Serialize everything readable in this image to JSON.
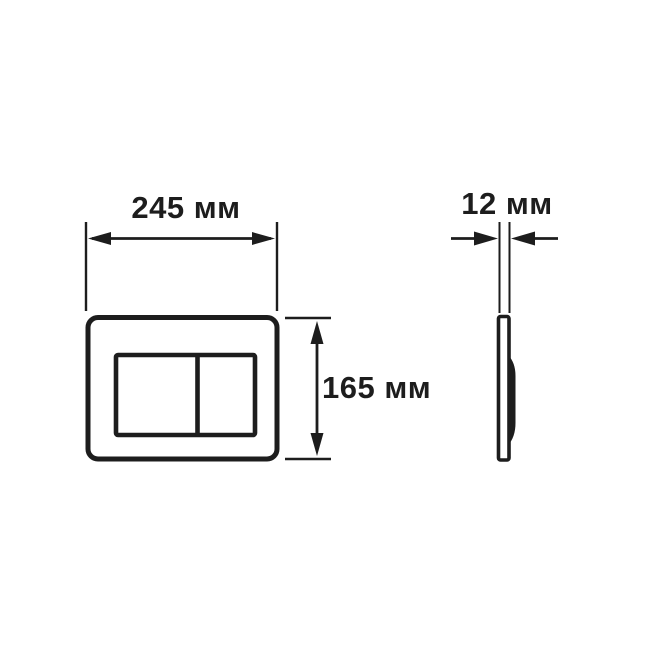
{
  "page": {
    "background_color": "#ffffff",
    "line_color": "#1d1d1d"
  },
  "drawing": {
    "front_view": {
      "width_dimension": {
        "value": "245",
        "unit": "мм",
        "label": "245 мм"
      },
      "height_dimension": {
        "value": "165",
        "unit": "мм",
        "label": "165 мм"
      }
    },
    "side_view": {
      "thickness_dimension": {
        "value": "12",
        "unit": "мм",
        "label": "12 мм"
      }
    }
  }
}
